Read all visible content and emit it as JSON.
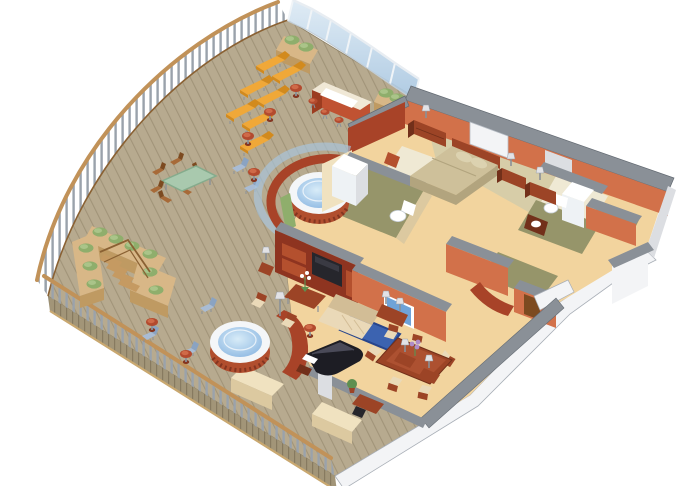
{
  "scene": {
    "description": "Isometric cutaway floor plan of a luxury cruise-ship suite with wrap-around teak veranda",
    "areas": [
      {
        "id": "veranda-deck",
        "items": [
          "teak-plank-floor",
          "curved-wood-railing",
          "glass-windscreen",
          "planter-hedges"
        ]
      },
      {
        "id": "sun-deck",
        "items": [
          "lounge-chair",
          "lounge-chair",
          "lounge-chair",
          "lounge-chair",
          "lounge-chair",
          "lounge-chair",
          "lounge-chair",
          "round-side-table",
          "round-side-table",
          "round-side-table"
        ]
      },
      {
        "id": "outdoor-bar",
        "items": [
          "bar-counter",
          "bar-stool",
          "bar-stool",
          "bar-stool",
          "bar-stool",
          "bar-stool"
        ]
      },
      {
        "id": "outdoor-dining",
        "items": [
          "glass-top-table",
          "wood-chair",
          "wood-chair",
          "wood-chair",
          "wood-chair",
          "wood-chair",
          "wood-chair"
        ]
      },
      {
        "id": "private-stairwell",
        "items": [
          "hedge-planter-enclosure",
          "staircase"
        ]
      },
      {
        "id": "upper-whirlpool",
        "items": [
          "round-hot-tub",
          "glass-privacy-screen"
        ]
      },
      {
        "id": "lower-whirlpool",
        "items": [
          "round-hot-tub",
          "deck-chair",
          "deck-chair",
          "deck-chair",
          "round-side-table",
          "round-side-table"
        ]
      },
      {
        "id": "master-bedroom",
        "items": [
          "queen-bed",
          "pillows",
          "wall-mirror",
          "nightstand",
          "nightstand",
          "dresser",
          "table-lamp",
          "table-lamp",
          "table-lamp",
          "accent-chair"
        ]
      },
      {
        "id": "master-bathroom",
        "items": [
          "shower",
          "toilet",
          "vanity"
        ]
      },
      {
        "id": "guest-bathroom",
        "items": [
          "shower",
          "toilet",
          "sink-vanity"
        ]
      },
      {
        "id": "walk-in-closet",
        "items": []
      },
      {
        "id": "living-room",
        "items": [
          "sofa",
          "armchair",
          "armchair",
          "coffee-table",
          "orchid-plant",
          "console-table",
          "table-lamp",
          "table-lamp",
          "floor-lamp",
          "blue-area-rug",
          "wall-tv",
          "entertainment-cabinet",
          "tv",
          "pedestal-table",
          "tripod-table"
        ]
      },
      {
        "id": "dining-area",
        "items": [
          "dining-table",
          "dining-chair",
          "dining-chair",
          "dining-chair",
          "dining-chair",
          "dining-chair",
          "dining-chair",
          "flower-centerpiece"
        ]
      },
      {
        "id": "music-corner",
        "items": [
          "grand-piano",
          "piano-bench",
          "potted-plant",
          "writing-desk",
          "desk-chair",
          "side-table",
          "side-table",
          "table-lamp",
          "table-lamp"
        ]
      },
      {
        "id": "entry-foyer",
        "items": [
          "curved-wall",
          "entry-door",
          "bench",
          "bench"
        ]
      }
    ]
  },
  "palette": {
    "bg": "#ffffff",
    "deck": "#b7aa8f",
    "plank": "#978a6f",
    "fascia": "#a29578",
    "fasciaLine": "#877a60",
    "fasciaTrim": "#c9a870",
    "railWood": "#c19259",
    "railDark": "#8a6133",
    "baluster": "#9aa2ab",
    "glass1": "#ddeaf4",
    "glass2": "#a8c6e0",
    "glassFrame": "#f0f4f7",
    "hullWhite": "#f3f4f6",
    "hullShade": "#dcdee2",
    "hullEdge": "#a8aeb6",
    "cap": "#8a9097",
    "capDark": "#636a72",
    "wallLight": "#d2714a",
    "wallDark": "#a84328",
    "wallRed": "#8e3420",
    "wallRedLight": "#b4502e",
    "cream": "#f0e2c0",
    "creamShade": "#dcc9a0",
    "floorLiving": "#f2d49e",
    "floorBed": "#d7cda8",
    "rugCream": "#efe9d4",
    "floorOlive": "#96956a",
    "water1": "#d8ecf8",
    "water2": "#86b3e0",
    "tubRim": "#f4f6f8",
    "tubBase": "#b14e2e",
    "tubBaseDark": "#843520",
    "hedge": "#8fae6c",
    "hedgeLight": "#aac489",
    "hedgeDark": "#6d8e50",
    "planter": "#d8b787",
    "planterSide": "#bf9a62",
    "lounger": "#f0a838",
    "loungerDark": "#d28a1d",
    "chairBlue": "#a9bcd4",
    "chairBlueDark": "#8aa3c2",
    "tableRed": "#b34a2e",
    "tableRedTop": "#cf6a48",
    "barRed": "#c05232",
    "barRedDark": "#9c3c20",
    "barTop": "#f0e8d6",
    "fixture": "#eef2f5",
    "woodMid": "#a76a38",
    "woodDark": "#7c4a20",
    "glassGreen": "#a9c9ae",
    "glassGreenEdge": "#85ab8c",
    "sofaCream": "#ead9b8",
    "sofaShade": "#d2bd96",
    "furnRed": "#9c4426",
    "furnRedDark": "#72301a",
    "bedSpread": "#cec09a",
    "bedSide": "#b2a47e",
    "pillow": "#dcd2b0",
    "piano": "#1d1d24",
    "pianoLight": "#4a4a58",
    "tvBlue": "#6fa3d8",
    "tvDark": "#26262c",
    "lampShade": "#e2e2e6",
    "lampStem": "#8a9098",
    "rugBlue": "#3c63b0",
    "rugBlueDark": "#27458c",
    "flowerPurple": "#b08cc8",
    "leaf": "#5f8f4f",
    "stairWood": "#c59a62"
  }
}
